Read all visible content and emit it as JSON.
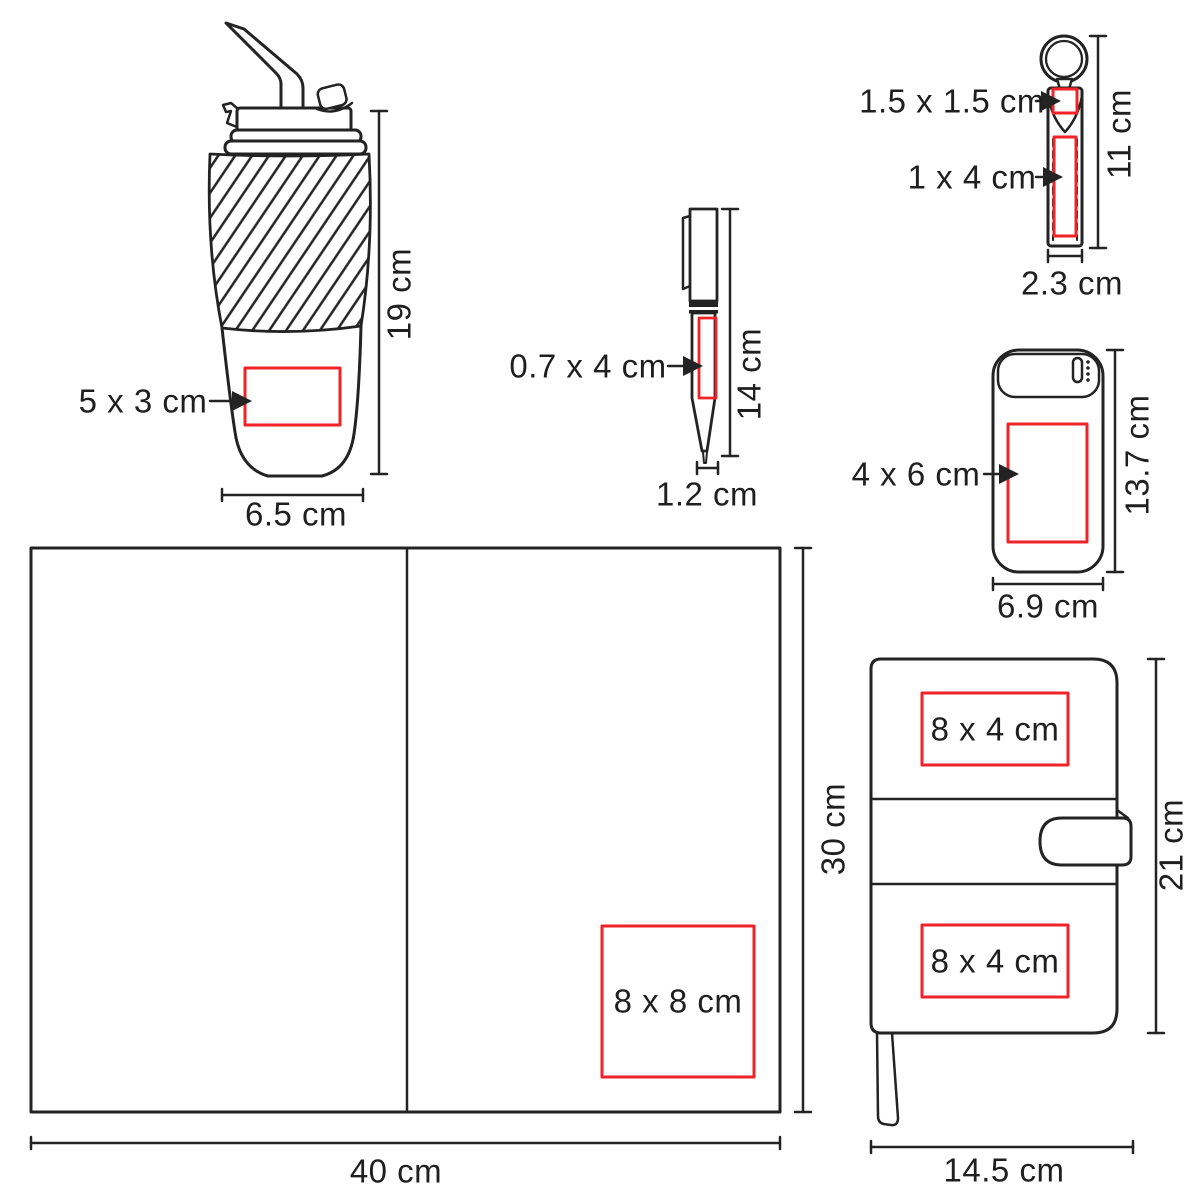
{
  "diagram": {
    "kind": "promotional products imprint-area spec sheet",
    "unit": "cm",
    "colors": {
      "stroke": "#232323",
      "print_area_red": "#ef2328",
      "text": "#1f1f1f"
    },
    "products": {
      "tumbler": {
        "name": "travel tumbler with straw",
        "print_area": "5 x 3 cm",
        "height": "19 cm",
        "width": "6.5 cm"
      },
      "pen": {
        "name": "ballpoint pen",
        "print_area": "0.7 x 4 cm",
        "height": "14 cm",
        "width": "1.2 cm"
      },
      "keychain": {
        "name": "strap keychain",
        "print_area_top": "1.5 x 1.5 cm",
        "print_area_strap": "1 x 4 cm",
        "height": "11 cm",
        "width": "2.3 cm"
      },
      "powerbank": {
        "name": "power bank",
        "print_area": "4 x 6 cm",
        "height": "13.7 cm",
        "width": "6.9 cm"
      },
      "folder": {
        "name": "open folder / placemat",
        "print_area": "8 x 8 cm",
        "height": "30 cm",
        "width": "40 cm"
      },
      "notebook": {
        "name": "notebook with clasp",
        "print_area_top": "8 x 4 cm",
        "print_area_bottom": "8 x 4 cm",
        "height": "21 cm",
        "width": "14.5 cm"
      }
    }
  }
}
